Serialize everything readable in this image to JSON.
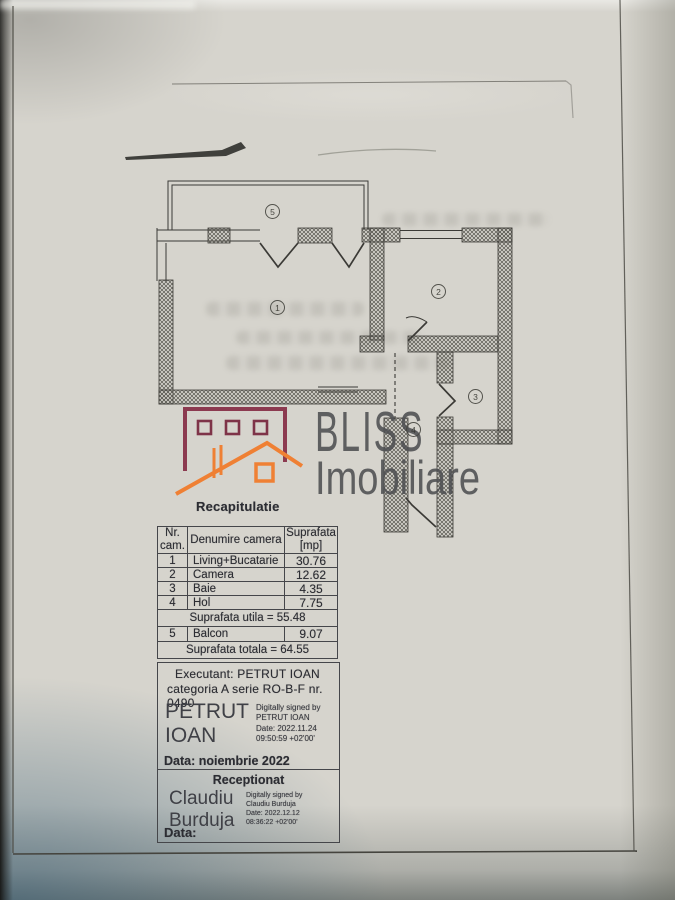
{
  "brand": {
    "name_top": "BLISS",
    "name_bottom": "Imobiliare",
    "logo_maroon": "#8c3a50",
    "logo_orange": "#ef8034",
    "watermark_gray": "#4e4f52"
  },
  "plan": {
    "room_labels": [
      "1",
      "2",
      "3",
      "4",
      "5"
    ]
  },
  "recap": {
    "title": "Recapitulatie",
    "headers": [
      "Nr. cam.",
      "Denumire camera",
      "Suprafata [mp]"
    ],
    "rows": [
      {
        "nr": "1",
        "name": "Living+Bucatarie",
        "area": "30.76"
      },
      {
        "nr": "2",
        "name": "Camera",
        "area": "12.62"
      },
      {
        "nr": "3",
        "name": "Baie",
        "area": "4.35"
      },
      {
        "nr": "4",
        "name": "Hol",
        "area": "7.75"
      }
    ],
    "subtotal": "Suprafata utila = 55.48",
    "balcony_row": {
      "nr": "5",
      "name": "Balcon",
      "area": "9.07"
    },
    "total": "Suprafata totala = 64.55"
  },
  "executant": {
    "line1": "Executant: PETRUT IOAN",
    "line2": "categoria A serie RO-B-F nr. 0490",
    "signature_name": "PETRUT IOAN",
    "signature_details": [
      "Digitally signed by",
      "PETRUT IOAN",
      "Date: 2022.11.24",
      "09:50:59 +02'00'"
    ],
    "date_line": "Data: noiembrie 2022"
  },
  "reception": {
    "title": "Receptionat",
    "signature_name": "Claudiu Burduja",
    "signature_details": [
      "Digitally signed by",
      "Claudiu Burduja",
      "Date: 2022.12.12",
      "08:36:22 +02'00'"
    ],
    "date_line": "Data:"
  }
}
